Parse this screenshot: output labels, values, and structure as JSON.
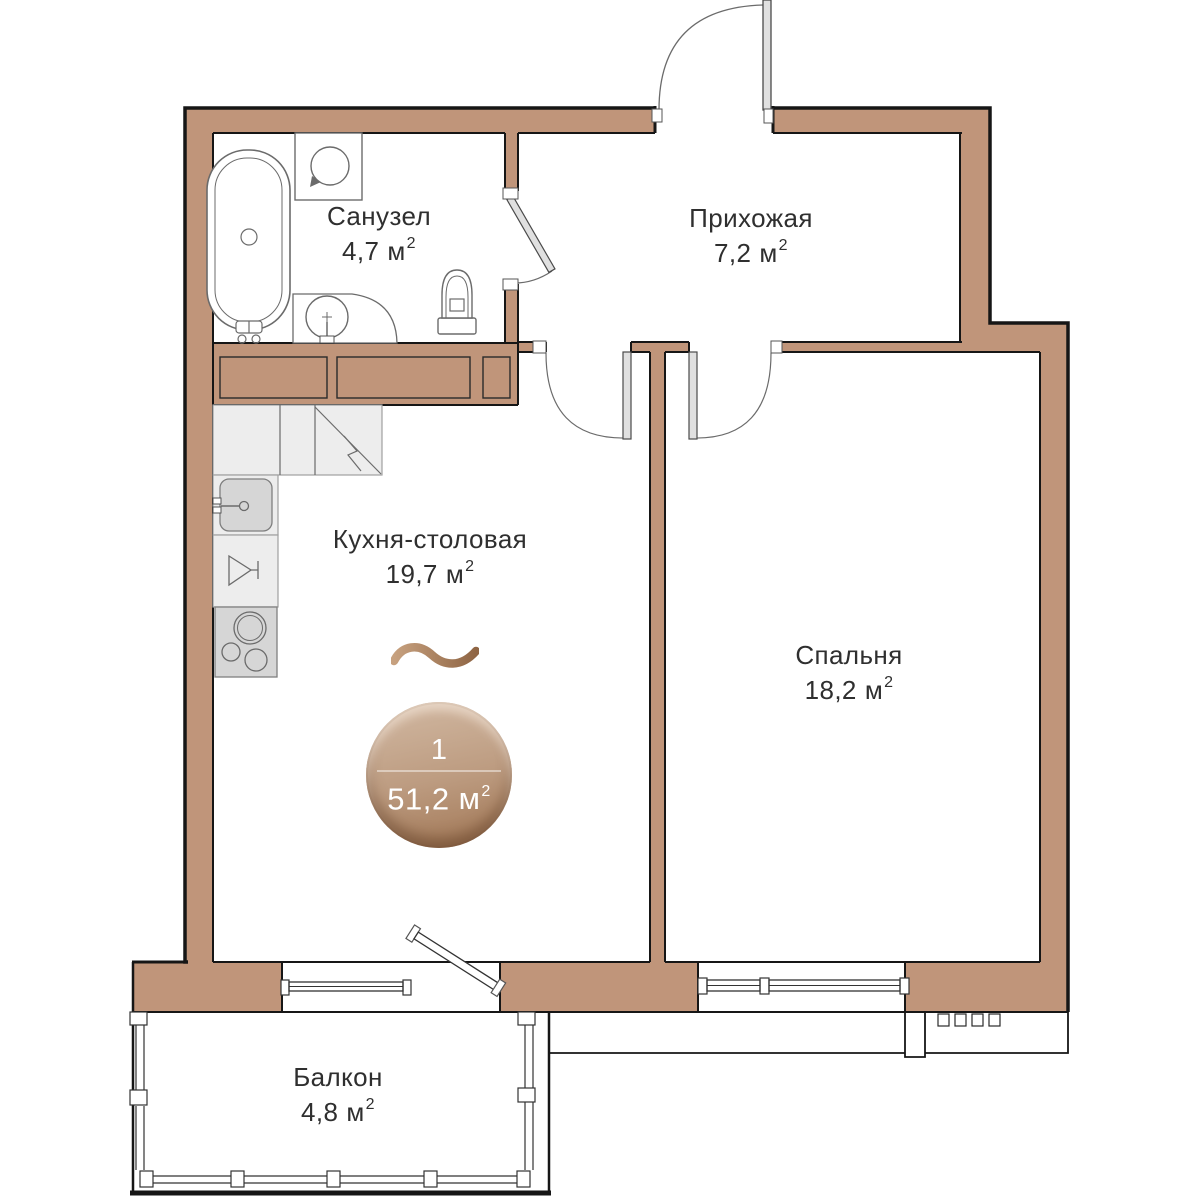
{
  "plan": {
    "title": "1-room apartment floor plan",
    "language": "ru",
    "badge": {
      "rooms_count": "1",
      "total_area": "51,2",
      "area_unit": "м",
      "area_power": "2"
    },
    "rooms": [
      {
        "id": "bathroom",
        "name": "Санузел",
        "area": "4,7",
        "unit": "м",
        "power": "2"
      },
      {
        "id": "hallway",
        "name": "Прихожая",
        "area": "7,2",
        "unit": "м",
        "power": "2"
      },
      {
        "id": "kitchen",
        "name": "Кухня-столовая",
        "area": "19,7",
        "unit": "м",
        "power": "2"
      },
      {
        "id": "bedroom",
        "name": "Спальня",
        "area": "18,2",
        "unit": "м",
        "power": "2"
      },
      {
        "id": "balcony",
        "name": "Балкон",
        "area": "4,8",
        "unit": "м",
        "power": "2"
      }
    ],
    "fixtures": [
      "bathtub",
      "washing-machine",
      "washbasin",
      "toilet",
      "kitchen-sink",
      "dishwasher",
      "stove",
      "corner-cabinet",
      "ventilation-grid"
    ],
    "colors": {
      "wall": "#c0957a",
      "outline": "#161616",
      "counter": "#ededed",
      "appliance": "#d6d6d6",
      "door_leaf": "#e0e0e0",
      "badge_light": "#cfb59e",
      "badge_dark": "#a07553",
      "logo_light": "#c7a17f",
      "logo_dark": "#8f6544",
      "text": "#2f2f2f"
    }
  }
}
